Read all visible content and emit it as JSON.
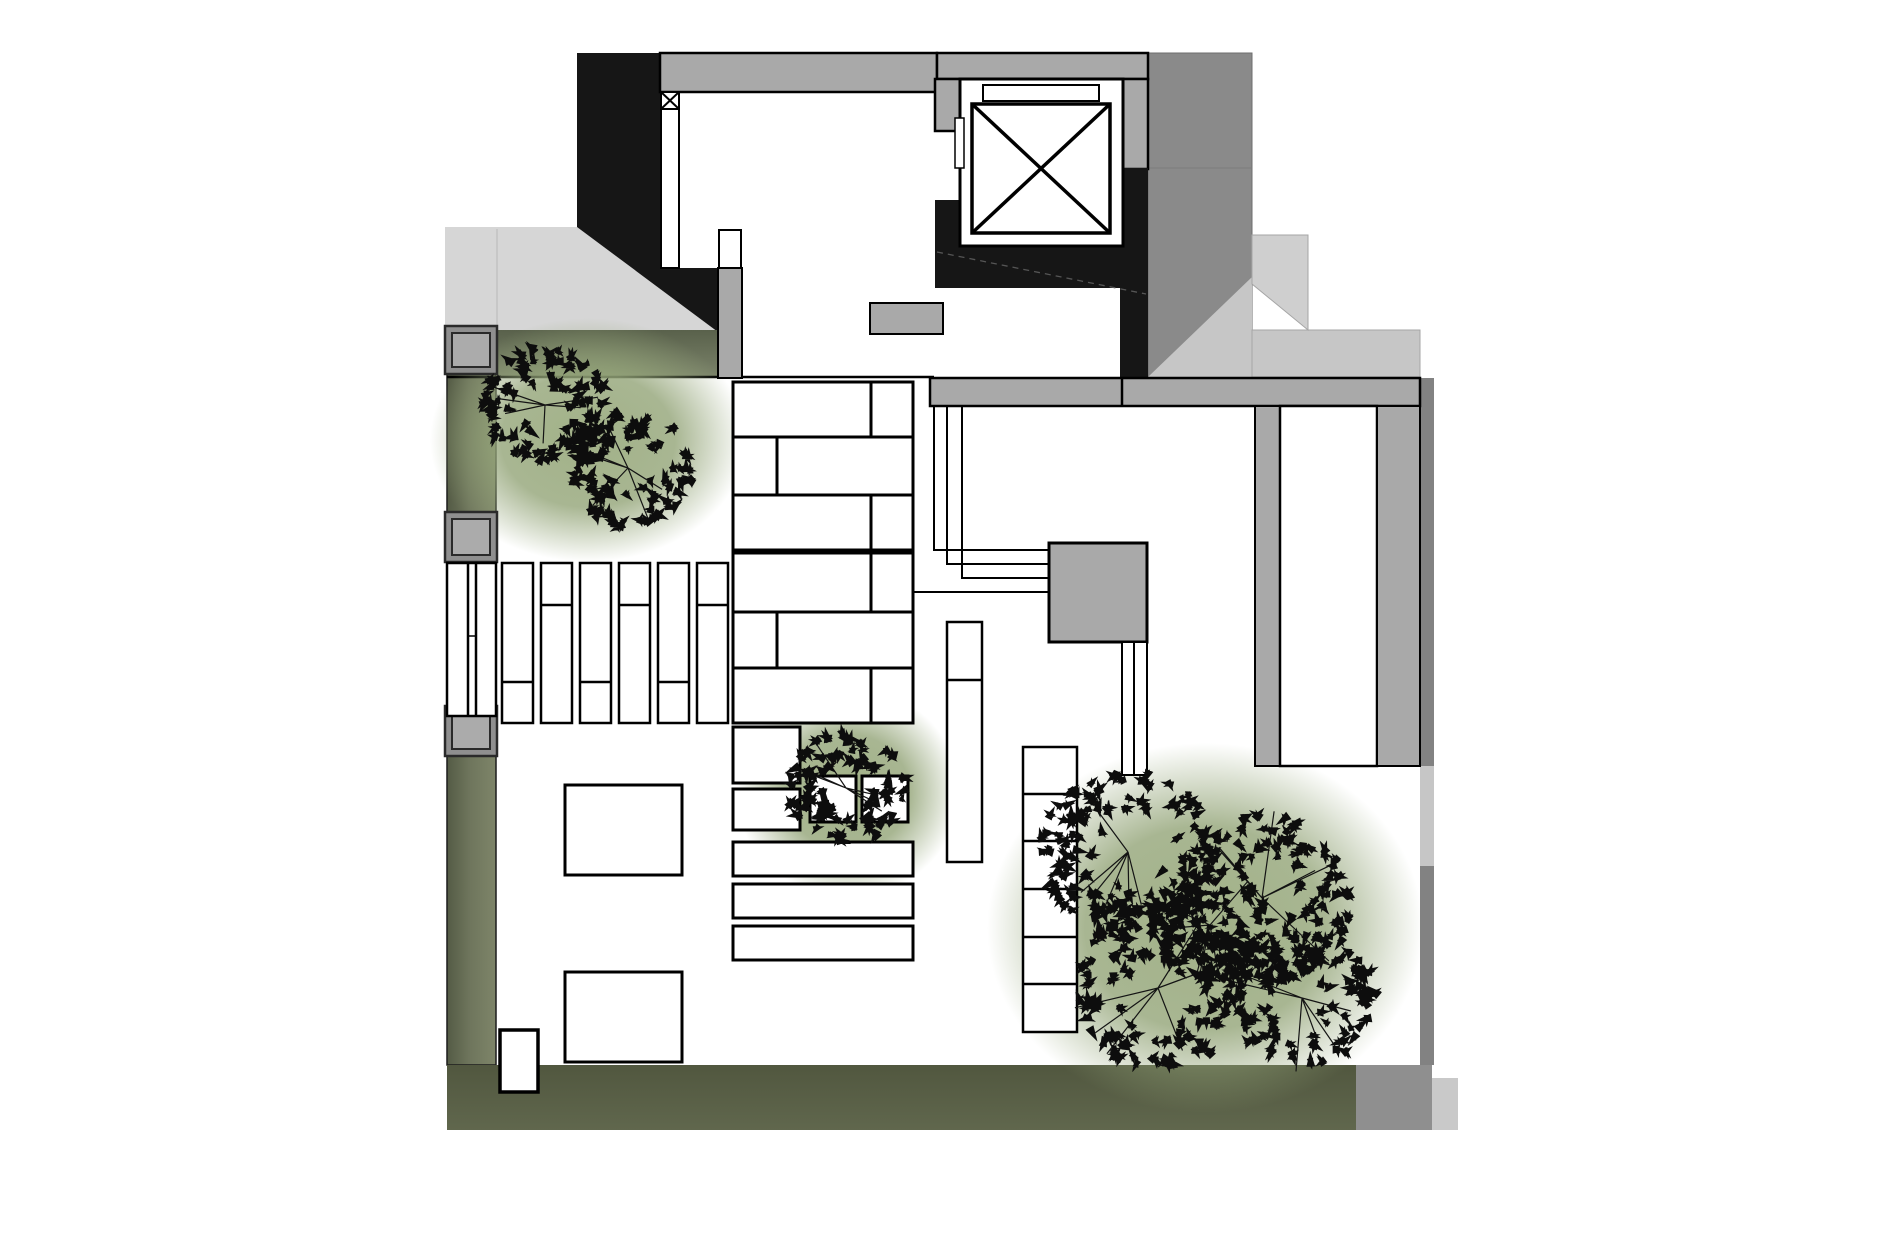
{
  "page": {
    "background": "#ffffff",
    "drawing_kind": "architectural-roof-terrace-plan"
  },
  "canvas": {
    "width": 1890,
    "height": 1259
  },
  "palette": {
    "black_mass": "#161616",
    "wall_gray": "#a9a9a9",
    "dark_roof": "#8a8a8a",
    "light_gray": "#d6d6d6",
    "ramp_gray": "#c6c6c6",
    "ramp_light": "#cfcfcf",
    "edge_gray": "#828282",
    "olive_dark": "#51573f",
    "olive_mid": "#6e755c",
    "olive_light": "#7b836a",
    "halo_green": "#9aab7e",
    "paper_white": "#ffffff",
    "line_black": "#000000"
  },
  "gradients": [
    {
      "id": "gradOliveH",
      "kind": "linear",
      "x1": 0,
      "y1": 0,
      "x2": 1,
      "y2": 0,
      "stops": [
        [
          "0%",
          "#545b45",
          1
        ],
        [
          "45%",
          "#6e755c",
          1
        ],
        [
          "100%",
          "#7e8569",
          1
        ]
      ]
    },
    {
      "id": "gradOliveV",
      "kind": "linear",
      "x1": 0,
      "y1": 0,
      "x2": 0,
      "y2": 1,
      "stops": [
        [
          "0%",
          "#59614b",
          1
        ],
        [
          "100%",
          "#7b836a",
          1
        ]
      ]
    },
    {
      "id": "gradOliveB",
      "kind": "linear",
      "x1": 0,
      "y1": 0,
      "x2": 0,
      "y2": 1,
      "stops": [
        [
          "0%",
          "#51573f",
          1
        ],
        [
          "100%",
          "#60674d",
          1
        ]
      ]
    },
    {
      "id": "gradHalo",
      "kind": "radial",
      "stops": [
        [
          "0%",
          "#9aab7e",
          0.92
        ],
        [
          "55%",
          "#95a67a",
          0.82
        ],
        [
          "100%",
          "#95a67a",
          0
        ]
      ]
    }
  ],
  "elements": [
    {
      "name": "entry-canopy-lightgray",
      "type": "poly",
      "points": [
        [
          445,
          227
        ],
        [
          577,
          227
        ],
        [
          718,
          332
        ],
        [
          445,
          332
        ]
      ],
      "fill": "#d6d6d6"
    },
    {
      "name": "canopy-seam-line",
      "type": "line",
      "x1": 497,
      "y1": 229,
      "x2": 497,
      "y2": 331,
      "stroke": "#c2c2c2",
      "sw": 1.5
    },
    {
      "name": "dark-roof-block",
      "type": "rect",
      "x": 1148,
      "y": 53,
      "w": 104,
      "h": 324,
      "fill": "#8a8a8a",
      "stroke": "#6e6e6e",
      "sw": 1
    },
    {
      "name": "dark-roof-seam",
      "type": "line",
      "x1": 1148,
      "y1": 168,
      "x2": 1252,
      "y2": 168,
      "stroke": "#7c7c7c",
      "sw": 1
    },
    {
      "name": "ramp-triangle",
      "type": "poly",
      "points": [
        [
          1148,
          377
        ],
        [
          1252,
          277
        ],
        [
          1252,
          377
        ]
      ],
      "fill": "#c6c6c6"
    },
    {
      "name": "ramp-landing-band",
      "type": "rect",
      "x": 1252,
      "y": 330,
      "w": 168,
      "h": 47,
      "fill": "#c6c6c6",
      "stroke": "#a5a5a5",
      "sw": 1
    },
    {
      "name": "ramp-upper-flight",
      "type": "poly",
      "points": [
        [
          1252,
          235
        ],
        [
          1308,
          235
        ],
        [
          1308,
          330
        ],
        [
          1252,
          284
        ]
      ],
      "fill": "#cfcfcf",
      "stroke": "#a5a5a5",
      "sw": 1
    },
    {
      "name": "stair-core-black-mass",
      "type": "poly",
      "points": [
        [
          577,
          53
        ],
        [
          660,
          53
        ],
        [
          660,
          92
        ],
        [
          662,
          92
        ],
        [
          662,
          268
        ],
        [
          718,
          268
        ],
        [
          718,
          332
        ],
        [
          577,
          227
        ]
      ],
      "fill": "#161616"
    },
    {
      "name": "top-wall",
      "type": "rect",
      "x": 660,
      "y": 53,
      "w": 277,
      "h": 39,
      "fill": "#a9a9a9",
      "stroke": "#000000",
      "sw": 2.5
    },
    {
      "name": "lobby-top-wall",
      "type": "rect",
      "x": 937,
      "y": 53,
      "w": 211,
      "h": 26,
      "fill": "#a9a9a9",
      "stroke": "#000000",
      "sw": 2.5
    },
    {
      "name": "lobby-corner-wall",
      "type": "rect",
      "x": 1120,
      "y": 79,
      "w": 28,
      "h": 90,
      "fill": "#a9a9a9",
      "stroke": "#000000",
      "sw": 2.5
    },
    {
      "name": "wall-step",
      "type": "rect",
      "x": 935,
      "y": 79,
      "w": 27,
      "h": 52,
      "fill": "#a9a9a9",
      "stroke": "#000000",
      "sw": 2.5
    },
    {
      "name": "planting-strip-west",
      "type": "rect",
      "x": 447,
      "y": 332,
      "w": 49,
      "h": 733,
      "fill": "url(#gradOliveH)",
      "stroke": "#1c1c1c",
      "sw": 1.5
    },
    {
      "name": "planting-band-north",
      "type": "rect",
      "x": 496,
      "y": 330,
      "w": 222,
      "h": 47,
      "fill": "url(#gradOliveV)"
    },
    {
      "name": "planting-band-south",
      "type": "rect",
      "x": 447,
      "y": 1065,
      "w": 909,
      "h": 65,
      "fill": "url(#gradOliveB)"
    },
    {
      "name": "south-band-gray-end",
      "type": "rect",
      "x": 1356,
      "y": 1065,
      "w": 76,
      "h": 65,
      "fill": "#8f8f8f"
    },
    {
      "name": "southeast-step",
      "type": "rect",
      "x": 1432,
      "y": 1078,
      "w": 26,
      "h": 52,
      "fill": "#c9c9c9"
    },
    {
      "name": "east-edge-strip",
      "type": "rect",
      "x": 1420,
      "y": 378,
      "w": 14,
      "h": 687,
      "fill": "#828282"
    },
    {
      "name": "east-edge-light-segment",
      "type": "rect",
      "x": 1420,
      "y": 766,
      "w": 14,
      "h": 100,
      "fill": "#c6c6c6"
    },
    {
      "name": "terrace-edge-line",
      "type": "line",
      "x1": 447,
      "y1": 377,
      "x2": 934,
      "y2": 377,
      "stroke": "#000000",
      "sw": 2.5
    },
    {
      "name": "tree-halo-northwest",
      "type": "halo",
      "cx": 588,
      "cy": 440,
      "rx": 158,
      "ry": 122
    },
    {
      "name": "tree-halo-center",
      "type": "halo",
      "cx": 848,
      "cy": 792,
      "rx": 112,
      "ry": 105
    },
    {
      "name": "tree-halo-southeast",
      "type": "halo",
      "cx": 1205,
      "cy": 928,
      "rx": 218,
      "ry": 185
    },
    {
      "name": "elevator-black-west",
      "type": "rect",
      "x": 935,
      "y": 200,
      "w": 27,
      "h": 46,
      "fill": "#161616"
    },
    {
      "name": "elevator-black-south",
      "type": "rect",
      "x": 935,
      "y": 246,
      "w": 185,
      "h": 42,
      "fill": "#161616"
    },
    {
      "name": "elevator-black-east",
      "type": "rect",
      "x": 1120,
      "y": 168,
      "w": 28,
      "h": 210,
      "fill": "#161616"
    },
    {
      "name": "elevator-room",
      "type": "rect",
      "x": 960,
      "y": 79,
      "w": 163,
      "h": 167,
      "fill": "#ffffff",
      "stroke": "#000000",
      "sw": 3
    },
    {
      "name": "elevator-door-slab",
      "type": "rect",
      "x": 983,
      "y": 85,
      "w": 116,
      "h": 16,
      "fill": "#ffffff",
      "stroke": "#000000",
      "sw": 2
    },
    {
      "name": "elevator-cab-symbol",
      "type": "xbox",
      "x": 972,
      "y": 104,
      "w": 138,
      "h": 129,
      "fill": "#ffffff",
      "stroke": "#000000",
      "sw": 3.5
    },
    {
      "name": "elevator-jamb",
      "type": "rect",
      "x": 955,
      "y": 118,
      "w": 9,
      "h": 50,
      "fill": "#ffffff",
      "stroke": "#000000",
      "sw": 1.5
    },
    {
      "name": "stair-flight-line",
      "type": "line",
      "x1": 937,
      "y1": 252,
      "x2": 1146,
      "y2": 294,
      "stroke": "#555555",
      "sw": 1.3,
      "dash": "6 5"
    },
    {
      "name": "entry-column-box",
      "type": "xbox",
      "x": 661,
      "y": 92,
      "w": 18,
      "h": 17,
      "fill": "#ffffff",
      "stroke": "#000000",
      "sw": 2
    },
    {
      "name": "door-track-west",
      "type": "rect",
      "x": 661,
      "y": 109,
      "w": 18,
      "h": 159,
      "fill": "#ffffff",
      "stroke": "#000000",
      "sw": 2
    },
    {
      "name": "door-track-east-top",
      "type": "rect",
      "x": 719,
      "y": 230,
      "w": 22,
      "h": 38,
      "fill": "#ffffff",
      "stroke": "#000000",
      "sw": 2
    },
    {
      "name": "door-track-east-pier",
      "type": "rect",
      "x": 718,
      "y": 268,
      "w": 24,
      "h": 110,
      "fill": "#a9a9a9",
      "stroke": "#000000",
      "sw": 2
    },
    {
      "name": "service-box-north",
      "type": "rect",
      "x": 870,
      "y": 303,
      "w": 73,
      "h": 31,
      "fill": "#a9a9a9",
      "stroke": "#000000",
      "sw": 2
    },
    {
      "name": "planter-frame-1",
      "type": "rect",
      "x": 445,
      "y": 326,
      "w": 52,
      "h": 48,
      "fill": "#8f8f8f",
      "stroke": "#2a2a2a",
      "sw": 2.5
    },
    {
      "name": "planter-1",
      "type": "rect",
      "x": 452,
      "y": 333,
      "w": 38,
      "h": 34,
      "fill": "#ababab",
      "stroke": "#2a2a2a",
      "sw": 2
    },
    {
      "name": "planter-frame-2",
      "type": "rect",
      "x": 445,
      "y": 512,
      "w": 52,
      "h": 50,
      "fill": "#8f8f8f",
      "stroke": "#2a2a2a",
      "sw": 2.5
    },
    {
      "name": "planter-2",
      "type": "rect",
      "x": 452,
      "y": 519,
      "w": 38,
      "h": 36,
      "fill": "#ababab",
      "stroke": "#2a2a2a",
      "sw": 2
    },
    {
      "name": "planter-frame-3",
      "type": "rect",
      "x": 445,
      "y": 706,
      "w": 52,
      "h": 50,
      "fill": "#8f8f8f",
      "stroke": "#2a2a2a",
      "sw": 2.5
    },
    {
      "name": "planter-3",
      "type": "rect",
      "x": 452,
      "y": 713,
      "w": 38,
      "h": 36,
      "fill": "#ababab",
      "stroke": "#2a2a2a",
      "sw": 2
    },
    {
      "name": "strip-gate",
      "type": "rect",
      "x": 447,
      "y": 563,
      "w": 49,
      "h": 153,
      "fill": "#ffffff",
      "stroke": "#000000",
      "sw": 2.5,
      "vlines": [
        468,
        476
      ]
    },
    {
      "name": "strip-gate-latch",
      "type": "line",
      "x1": 468,
      "y1": 636,
      "x2": 476,
      "y2": 636,
      "stroke": "#000000",
      "sw": 1.5
    },
    {
      "name": "louver-slat-1",
      "type": "rect",
      "x": 502,
      "y": 563,
      "w": 31,
      "h": 160,
      "fill": "#ffffff",
      "stroke": "#000000",
      "sw": 2.5,
      "hlines": [
        682
      ]
    },
    {
      "name": "louver-slat-2",
      "type": "rect",
      "x": 541,
      "y": 563,
      "w": 31,
      "h": 160,
      "fill": "#ffffff",
      "stroke": "#000000",
      "sw": 2.5,
      "hlines": [
        605
      ]
    },
    {
      "name": "louver-slat-3",
      "type": "rect",
      "x": 580,
      "y": 563,
      "w": 31,
      "h": 160,
      "fill": "#ffffff",
      "stroke": "#000000",
      "sw": 2.5,
      "hlines": [
        682
      ]
    },
    {
      "name": "louver-slat-4",
      "type": "rect",
      "x": 619,
      "y": 563,
      "w": 31,
      "h": 160,
      "fill": "#ffffff",
      "stroke": "#000000",
      "sw": 2.5,
      "hlines": [
        605
      ]
    },
    {
      "name": "louver-slat-5",
      "type": "rect",
      "x": 658,
      "y": 563,
      "w": 31,
      "h": 160,
      "fill": "#ffffff",
      "stroke": "#000000",
      "sw": 2.5,
      "hlines": [
        682
      ]
    },
    {
      "name": "louver-slat-6",
      "type": "rect",
      "x": 697,
      "y": 563,
      "w": 31,
      "h": 160,
      "fill": "#ffffff",
      "stroke": "#000000",
      "sw": 2.5,
      "hlines": [
        605
      ]
    },
    {
      "name": "paver-row-1",
      "type": "rect",
      "x": 733,
      "y": 382,
      "w": 180,
      "h": 55,
      "fill": "#ffffff",
      "stroke": "#000000",
      "sw": 3,
      "vlines": [
        871
      ]
    },
    {
      "name": "paver-row-2",
      "type": "rect",
      "x": 733,
      "y": 437,
      "w": 180,
      "h": 58,
      "fill": "#ffffff",
      "stroke": "#000000",
      "sw": 3,
      "vlines": [
        777
      ]
    },
    {
      "name": "paver-row-3",
      "type": "rect",
      "x": 733,
      "y": 495,
      "w": 180,
      "h": 55,
      "fill": "#ffffff",
      "stroke": "#000000",
      "sw": 3,
      "vlines": [
        871
      ]
    },
    {
      "name": "paver-row-4",
      "type": "rect",
      "x": 733,
      "y": 553,
      "w": 180,
      "h": 59,
      "fill": "#ffffff",
      "stroke": "#000000",
      "sw": 3,
      "vlines": [
        871
      ]
    },
    {
      "name": "paver-row-5",
      "type": "rect",
      "x": 733,
      "y": 612,
      "w": 180,
      "h": 56,
      "fill": "#ffffff",
      "stroke": "#000000",
      "sw": 3,
      "vlines": [
        777
      ]
    },
    {
      "name": "paver-row-6",
      "type": "rect",
      "x": 733,
      "y": 668,
      "w": 180,
      "h": 55,
      "fill": "#ffffff",
      "stroke": "#000000",
      "sw": 3,
      "vlines": [
        871
      ]
    },
    {
      "name": "paver-box-a",
      "type": "rect",
      "x": 733,
      "y": 727,
      "w": 67,
      "h": 56,
      "fill": "#ffffff",
      "stroke": "#000000",
      "sw": 3
    },
    {
      "name": "paver-box-b",
      "type": "rect",
      "x": 733,
      "y": 789,
      "w": 67,
      "h": 41,
      "fill": "#ffffff",
      "stroke": "#000000",
      "sw": 3
    },
    {
      "name": "paver-square-a",
      "type": "rect",
      "x": 810,
      "y": 776,
      "w": 46,
      "h": 46,
      "fill": "#ffffff",
      "stroke": "#000000",
      "sw": 3
    },
    {
      "name": "paver-square-b",
      "type": "rect",
      "x": 862,
      "y": 776,
      "w": 46,
      "h": 46,
      "fill": "#ffffff",
      "stroke": "#000000",
      "sw": 3
    },
    {
      "name": "paver-slat-1",
      "type": "rect",
      "x": 733,
      "y": 842,
      "w": 180,
      "h": 34,
      "fill": "#ffffff",
      "stroke": "#000000",
      "sw": 3
    },
    {
      "name": "paver-slat-2",
      "type": "rect",
      "x": 733,
      "y": 884,
      "w": 180,
      "h": 34,
      "fill": "#ffffff",
      "stroke": "#000000",
      "sw": 3
    },
    {
      "name": "paver-slat-3",
      "type": "rect",
      "x": 733,
      "y": 926,
      "w": 180,
      "h": 34,
      "fill": "#ffffff",
      "stroke": "#000000",
      "sw": 3
    },
    {
      "name": "bench-long",
      "type": "rect",
      "x": 947,
      "y": 622,
      "w": 35,
      "h": 240,
      "fill": "#ffffff",
      "stroke": "#000000",
      "sw": 2.5,
      "hlines": [
        680
      ]
    },
    {
      "name": "terrace-table-a",
      "type": "rect",
      "x": 565,
      "y": 785,
      "w": 117,
      "h": 90,
      "fill": "#ffffff",
      "stroke": "#000000",
      "sw": 3
    },
    {
      "name": "terrace-table-b",
      "type": "rect",
      "x": 565,
      "y": 972,
      "w": 117,
      "h": 90,
      "fill": "#ffffff",
      "stroke": "#000000",
      "sw": 3
    },
    {
      "name": "garden-gate-box",
      "type": "rect",
      "x": 500,
      "y": 1030,
      "w": 38,
      "h": 62,
      "fill": "#ffffff",
      "stroke": "#000000",
      "sw": 3.5
    },
    {
      "name": "rail-1",
      "type": "pline",
      "points": [
        [
          934,
          380
        ],
        [
          934,
          550
        ],
        [
          1049,
          550
        ]
      ],
      "stroke": "#000000",
      "sw": 2
    },
    {
      "name": "rail-2",
      "type": "pline",
      "points": [
        [
          947,
          380
        ],
        [
          947,
          564
        ],
        [
          1049,
          564
        ]
      ],
      "stroke": "#000000",
      "sw": 2
    },
    {
      "name": "rail-3",
      "type": "pline",
      "points": [
        [
          962,
          380
        ],
        [
          962,
          578
        ],
        [
          1049,
          578
        ]
      ],
      "stroke": "#000000",
      "sw": 2
    },
    {
      "name": "rail-4",
      "type": "line",
      "x1": 913,
      "y1": 592,
      "x2": 1049,
      "y2": 592,
      "stroke": "#000000",
      "sw": 2
    },
    {
      "name": "equipment-pad",
      "type": "rect",
      "x": 1049,
      "y": 543,
      "w": 98,
      "h": 99,
      "fill": "#a9a9a9",
      "stroke": "#000000",
      "sw": 3
    },
    {
      "name": "drain-channel",
      "type": "rect",
      "x": 1122,
      "y": 642,
      "w": 25,
      "h": 133,
      "fill": "#ffffff",
      "stroke": "#000000",
      "sw": 2,
      "vlines": [
        1134
      ]
    },
    {
      "name": "east-wall-band",
      "type": "rect",
      "x": 930,
      "y": 378,
      "w": 490,
      "h": 28,
      "fill": "#a9a9a9",
      "stroke": "#000000",
      "sw": 2.5,
      "vlines": [
        1122
      ]
    },
    {
      "name": "east-mullion",
      "type": "rect",
      "x": 1255,
      "y": 406,
      "w": 25,
      "h": 360,
      "fill": "#a9a9a9",
      "stroke": "#000000",
      "sw": 2
    },
    {
      "name": "skylight-bar",
      "type": "rect",
      "x": 1280,
      "y": 406,
      "w": 97,
      "h": 360,
      "fill": "#ffffff",
      "stroke": "#000000",
      "sw": 2.5
    },
    {
      "name": "east-wall-strip",
      "type": "rect",
      "x": 1377,
      "y": 406,
      "w": 43,
      "h": 360,
      "fill": "#a9a9a9",
      "stroke": "#000000",
      "sw": 2
    },
    {
      "name": "stair-ladder",
      "type": "rect",
      "x": 1023,
      "y": 747,
      "w": 54,
      "h": 285,
      "fill": "#ffffff",
      "stroke": "#000000",
      "sw": 2.5,
      "hlines": [
        794,
        841,
        889,
        937,
        984
      ]
    },
    {
      "name": "tree-northwest",
      "type": "canopy",
      "seed": 7,
      "clusters": [
        [
          545,
          405,
          62
        ],
        [
          628,
          468,
          64
        ]
      ]
    },
    {
      "name": "tree-center",
      "type": "canopy",
      "seed": 13,
      "clusters": [
        [
          846,
          788,
          60
        ]
      ]
    },
    {
      "name": "tree-southeast",
      "type": "canopy",
      "seed": 29,
      "clusters": [
        [
          1128,
          852,
          88
        ],
        [
          1262,
          898,
          92
        ],
        [
          1158,
          988,
          88
        ],
        [
          1302,
          998,
          74
        ],
        [
          1210,
          925,
          60
        ]
      ]
    }
  ]
}
